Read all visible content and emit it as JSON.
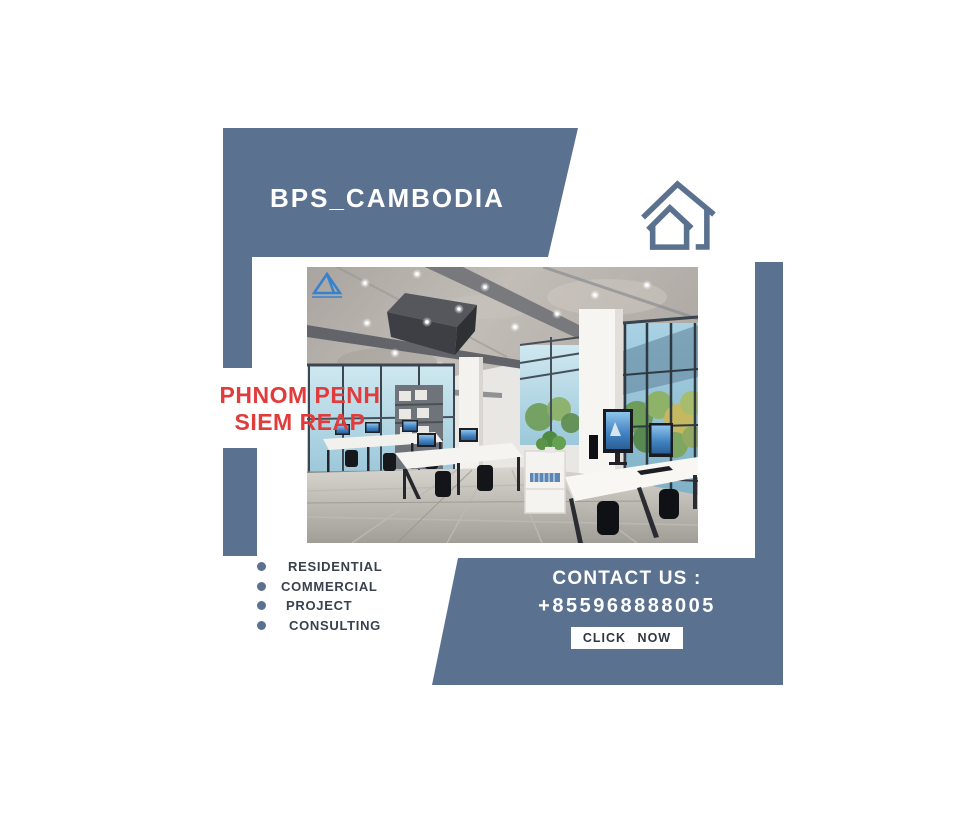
{
  "colors": {
    "accent": "#5b7190",
    "location_red": "#e23b3b",
    "text_dark": "#39414f",
    "button_text": "#2e3642",
    "white": "#ffffff"
  },
  "header": {
    "brand": "BPS_CAMBODIA"
  },
  "icons": {
    "home": "home-icon",
    "watermark": "watermark-logo-icon",
    "bullet": "bullet-dot-icon"
  },
  "locations": {
    "line1": "PHNOM PENH",
    "line2": "SIEM REAP"
  },
  "services": {
    "items": [
      {
        "label": "RESIDENTIAL"
      },
      {
        "label": "COMMERCIAL"
      },
      {
        "label": "PROJECT"
      },
      {
        "label": "CONSULTING"
      }
    ]
  },
  "contact": {
    "heading": "CONTACT US :",
    "phone": "+855968888005",
    "button_label": "CLICK NOW"
  }
}
